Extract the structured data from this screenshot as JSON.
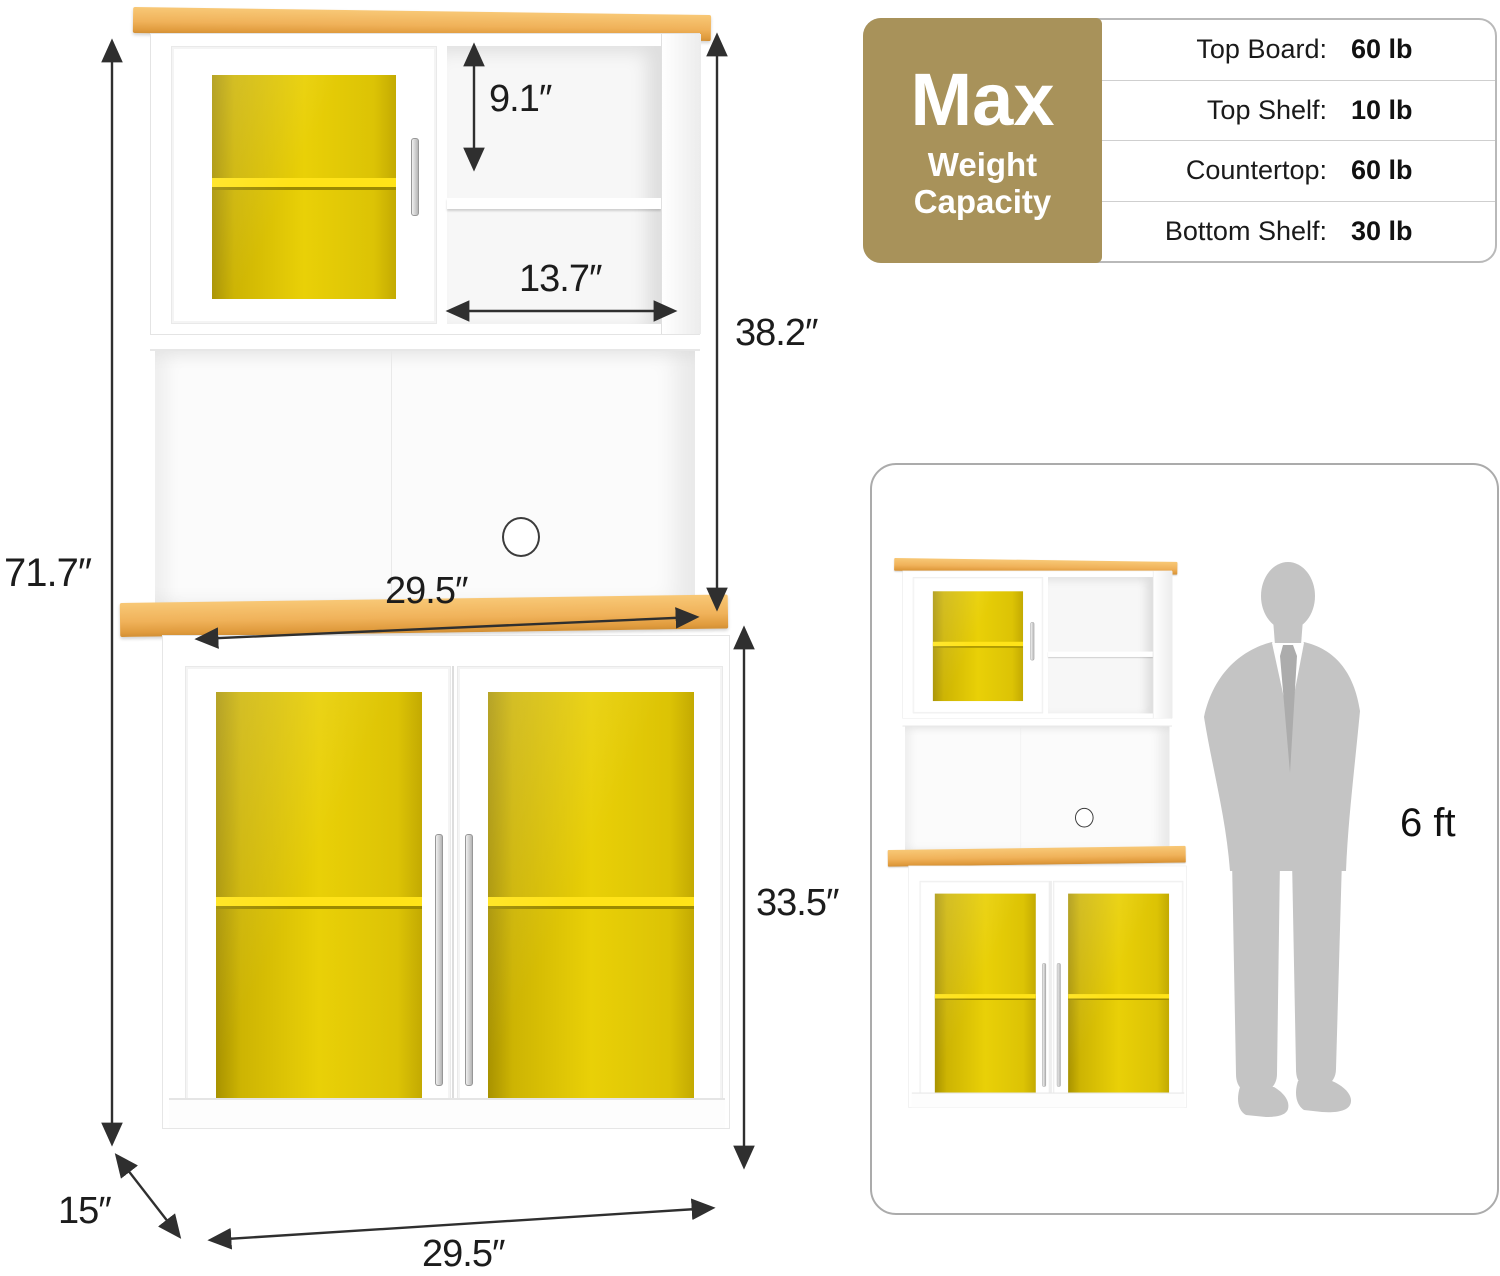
{
  "product_diagram": {
    "dimensions": {
      "overall_height": "71.7″",
      "top_shelf_height": "9.1″",
      "top_opening_width": "13.7″",
      "hutch_height": "38.2″",
      "countertop_width": "29.5″",
      "lower_cabinet_height": "33.5″",
      "depth": "15″",
      "base_width": "29.5″"
    },
    "weight_capacity": {
      "badge_title": "Max",
      "badge_subtitle_line1": "Weight",
      "badge_subtitle_line2": "Capacity",
      "badge_color": "#A8925A",
      "rows": [
        {
          "label": "Top Board:",
          "value": "60 lb"
        },
        {
          "label": "Top Shelf:",
          "value": "10 lb"
        },
        {
          "label": "Countertop:",
          "value": "60 lb"
        },
        {
          "label": "Bottom Shelf:",
          "value": "30 lb"
        }
      ]
    },
    "scale_panel": {
      "person_height_label": "6 ft"
    },
    "colors": {
      "wood": "#EFAD52",
      "interior_yellow": "#E9D007",
      "shelf_yellow": "#FFE318",
      "cabinet_white": "#FFFFFF",
      "dimension_line": "#2F2F2F",
      "silhouette_gray": "#C4C4C4"
    }
  }
}
